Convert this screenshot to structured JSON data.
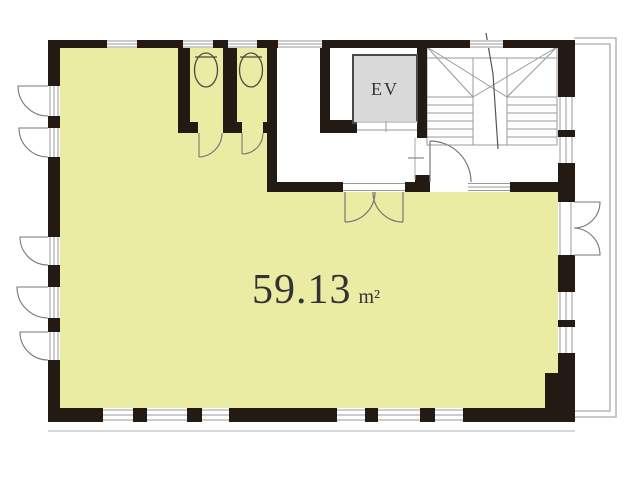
{
  "plan": {
    "title": "floor-plan",
    "room": {
      "area_value": "59.13",
      "area_unit": "m²"
    },
    "elevator": {
      "label": "EV"
    },
    "colors": {
      "wall": "#241a14",
      "room_fill": "#e9eca2",
      "elevator_fill": "#d9d9d9",
      "line": "#999999",
      "door_line": "#777777",
      "fixture_line": "#4a4a4a",
      "text": "#333333",
      "background": "#ffffff"
    }
  }
}
